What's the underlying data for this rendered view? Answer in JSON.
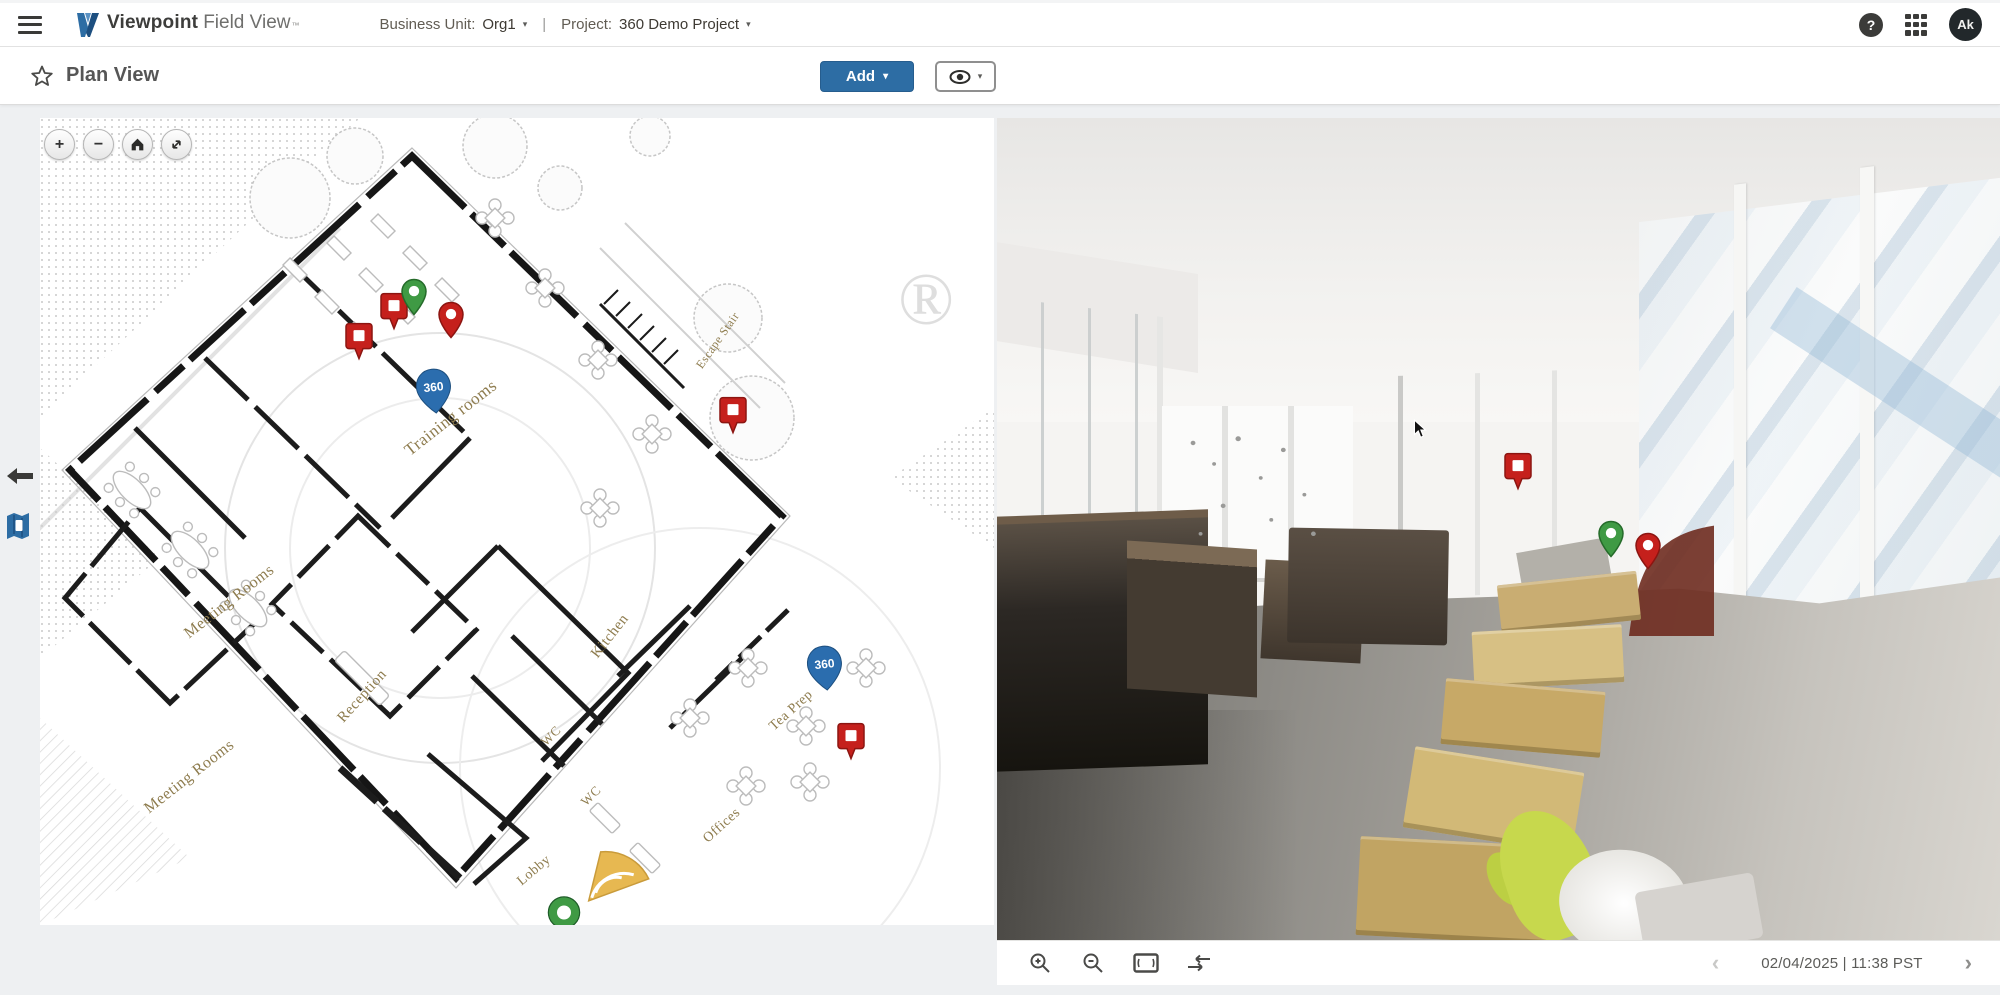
{
  "header": {
    "brand_bold": "Viewpoint",
    "brand_light": "Field View",
    "brand_tm": "™",
    "business_unit_label": "Business Unit:",
    "business_unit_value": "Org1",
    "divider": "|",
    "project_label": "Project:",
    "project_value": "360 Demo Project",
    "avatar_initials": "Ak"
  },
  "subheader": {
    "title": "Plan View",
    "add_button_label": "Add"
  },
  "icons": {
    "plus": "+",
    "minus": "−",
    "help": "?",
    "caret": "▾",
    "chevron_left": "‹",
    "chevron_right": "›"
  },
  "plan": {
    "badge_360_text": "360",
    "registered_mark": "®",
    "room_labels": [
      "Escape Stair",
      "Training rooms",
      "Meeting Rooms",
      "Reception",
      "Kitchen",
      "WC",
      "WC",
      "Tea Prep",
      "Offices",
      "Lobby",
      "Meeting Rooms"
    ],
    "pins": [
      {
        "type": "task-square",
        "x": 33.4,
        "y": 30.4
      },
      {
        "type": "task-square",
        "x": 37.1,
        "y": 26.6
      },
      {
        "type": "green-circle",
        "x": 39.2,
        "y": 24.8
      },
      {
        "type": "red-circle",
        "x": 43.1,
        "y": 27.6
      },
      {
        "type": "badge-360",
        "x": 41.3,
        "y": 37.1
      },
      {
        "type": "task-square",
        "x": 72.6,
        "y": 39.5
      },
      {
        "type": "badge-360",
        "x": 82.3,
        "y": 71.4
      },
      {
        "type": "task-square",
        "x": 85.0,
        "y": 79.9
      },
      {
        "type": "camera-ring",
        "x": 54.9,
        "y": 98.8
      },
      {
        "type": "camera-fan",
        "x": 57.5,
        "y": 97.6
      }
    ]
  },
  "photo": {
    "pins": [
      {
        "type": "task-square",
        "x": 51.9,
        "y": 45.6
      },
      {
        "type": "green-circle",
        "x": 61.2,
        "y": 53.8
      },
      {
        "type": "red-circle",
        "x": 64.9,
        "y": 55.2
      }
    ],
    "footer": {
      "date_display": "02/04/2025 | 11:38 PST"
    }
  },
  "colors": {
    "accent": "#2d6da4",
    "pin-red": "#c5201c",
    "pin-red-dark": "#8c1511",
    "pin-green": "#3f9a44",
    "pin-green-dark": "#256b2a",
    "badge-blue": "#2b6dae",
    "label-olive": "#8e7c4e"
  }
}
